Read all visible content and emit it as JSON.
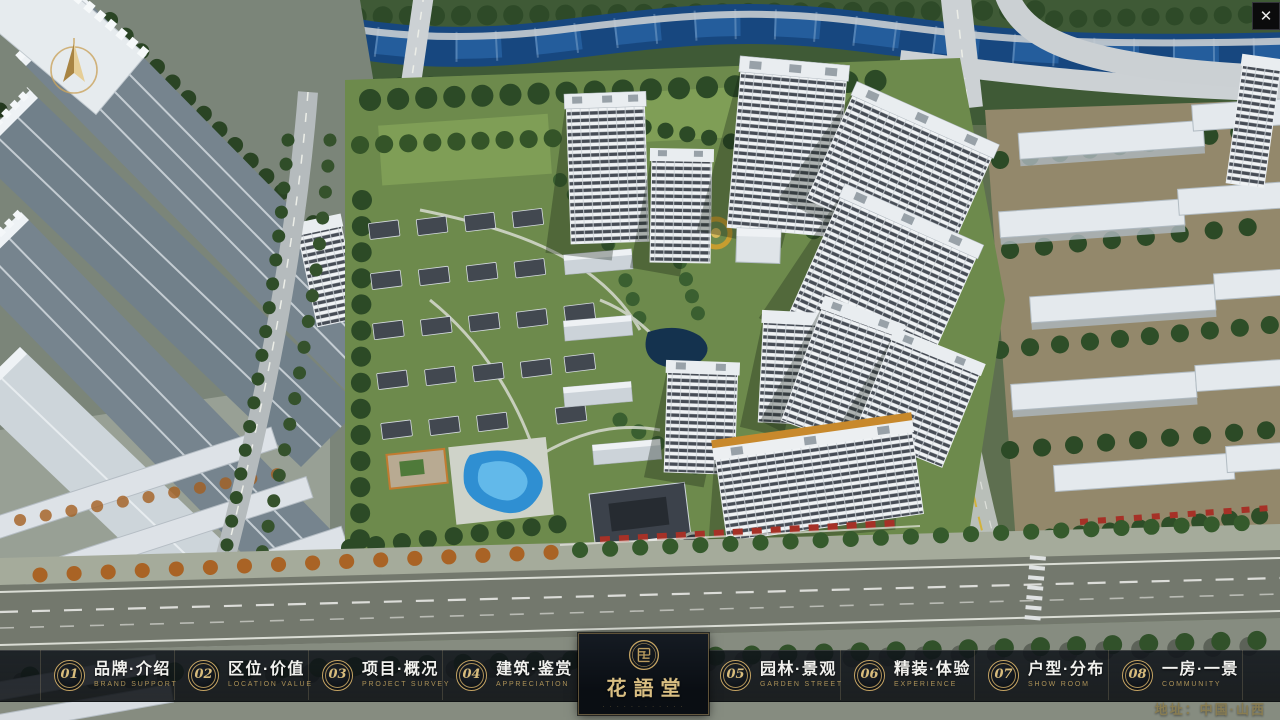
{
  "app": {
    "close_label": "✕"
  },
  "nav": {
    "items": [
      {
        "num": "01",
        "label": "品牌·介绍",
        "sub": "BRAND SUPPORT"
      },
      {
        "num": "02",
        "label": "区位·价值",
        "sub": "LOCATION VALUE"
      },
      {
        "num": "03",
        "label": "项目·概况",
        "sub": "PROJECT SURVEY"
      },
      {
        "num": "04",
        "label": "建筑·鉴赏",
        "sub": "APPRECIATION"
      },
      {
        "num": "05",
        "label": "园林·景观",
        "sub": "GARDEN STREET"
      },
      {
        "num": "06",
        "label": "精装·体验",
        "sub": "EXPERIENCE"
      },
      {
        "num": "07",
        "label": "户型·分布",
        "sub": "SHOW ROOM"
      },
      {
        "num": "08",
        "label": "一房·一景",
        "sub": "COMMUNITY"
      }
    ]
  },
  "logo": {
    "title": "花語堂",
    "tagline": "· · · · · · · · · · · ·"
  },
  "footer": {
    "address": "地址：中国·山西"
  },
  "colors": {
    "gold": "#c5a463",
    "nav_bg": "#0c1116",
    "logo_text": "#d9be82"
  }
}
